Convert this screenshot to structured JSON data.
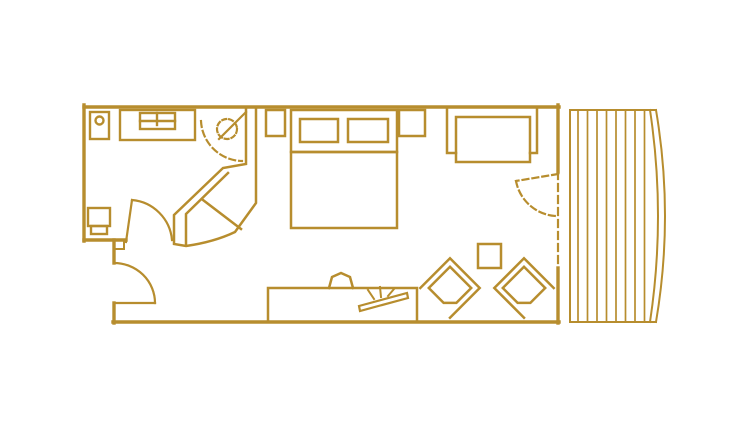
{
  "canvas": {
    "width": 754,
    "height": 435,
    "background": "#ffffff"
  },
  "colors": {
    "line": "#b78d2e",
    "background": "#ffffff"
  },
  "floorplan": {
    "type": "hotel-guestroom-floor-plan",
    "rooms": [
      "bathroom",
      "entry-hall",
      "bedroom",
      "lounge-corner",
      "balcony"
    ],
    "fixtures": [
      "wash-basin",
      "vanity-sink",
      "toilet",
      "walk-in-shower",
      "bathroom-door",
      "entry-door",
      "shower-door",
      "double-bed",
      "pillow-left",
      "pillow-right",
      "nightstand-left",
      "nightstand-right",
      "sofa",
      "desk-console",
      "desk-chair",
      "tv-on-console",
      "side-table",
      "armchair-left",
      "armchair-right",
      "balcony-door",
      "balcony-decking"
    ],
    "balcony": {
      "slat_count": 8,
      "slat_start_x": 578,
      "slat_spacing": 9.5,
      "slat_top_y": 110,
      "slat_bottom_y": 322
    }
  }
}
